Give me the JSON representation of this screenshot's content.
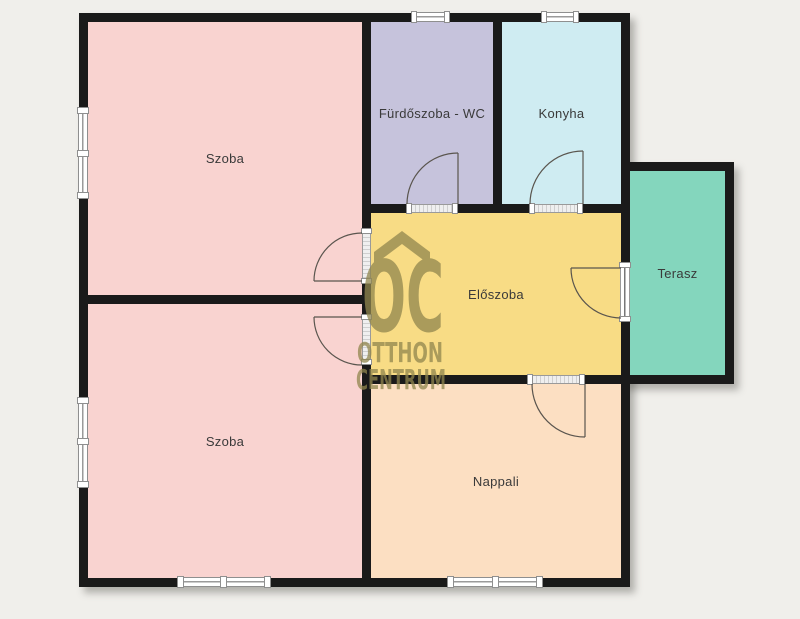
{
  "plan": {
    "type": "floor-plan",
    "rooms": [
      {
        "id": "szoba-top",
        "label": "Szoba",
        "color": "#f9d3d0"
      },
      {
        "id": "furdoszoba-wc",
        "label": "Fürdőszoba - WC",
        "color": "#c6c3dc"
      },
      {
        "id": "konyha",
        "label": "Konyha",
        "color": "#cfecf2"
      },
      {
        "id": "eloszoba",
        "label": "Előszoba",
        "color": "#f8dc85"
      },
      {
        "id": "terasz",
        "label": "Terasz",
        "color": "#84d6bd"
      },
      {
        "id": "szoba-bottom",
        "label": "Szoba",
        "color": "#f9d3d0"
      },
      {
        "id": "nappali",
        "label": "Nappali",
        "color": "#fcdfc2"
      }
    ],
    "watermark": {
      "logo": "OC",
      "line1": "OTTHON",
      "line2": "CENTRUM",
      "color": "#91864e"
    },
    "colors": {
      "background": "#f0efeb",
      "wall": "#1a1a1a",
      "label_text": "#3a3a3a",
      "door_swing": "#5a554e",
      "window_frame": "#8f8f8f"
    }
  }
}
